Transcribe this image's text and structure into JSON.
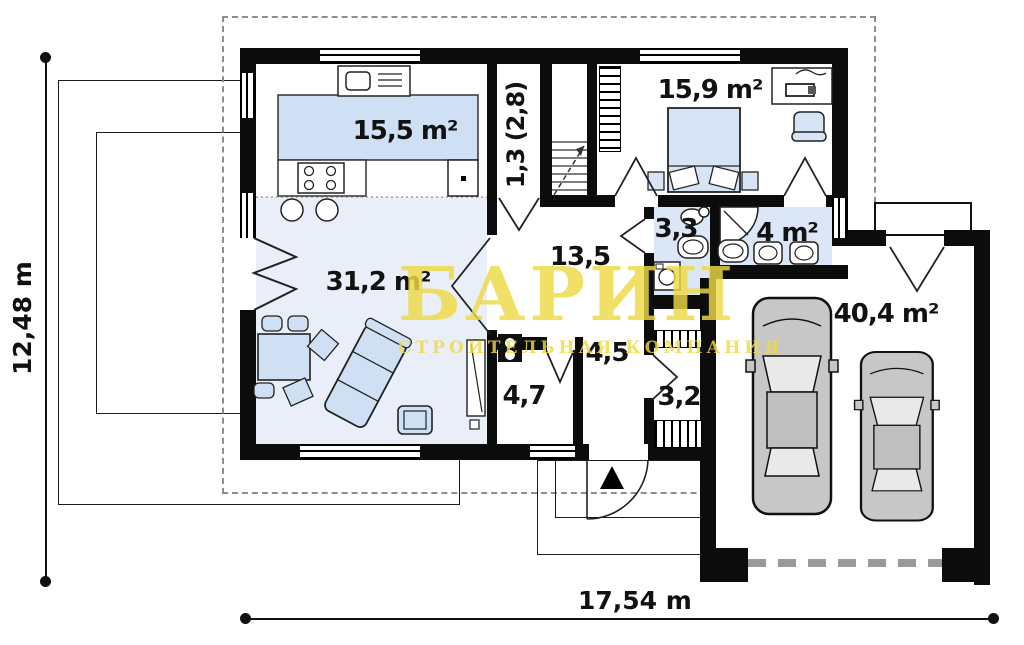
{
  "plan_title": "floor-plan",
  "rooms": {
    "kitchen": {
      "label": "15,5 m²"
    },
    "stairhall": {
      "label": "1,3 (2,8)"
    },
    "bedroom": {
      "label": "15,9 m²"
    },
    "wc": {
      "label": "3,3"
    },
    "bath": {
      "label": "4 m²"
    },
    "hall": {
      "label": "13,5"
    },
    "living": {
      "label": "31,2 m²"
    },
    "corridor": {
      "label": "4,5"
    },
    "utility": {
      "label": "4,7"
    },
    "entry": {
      "label": "3,2"
    },
    "garage": {
      "label": "40,4 m²"
    }
  },
  "dimensions": {
    "height": "12,48 m",
    "width": "17,54 m"
  },
  "watermark": {
    "title": "БАРИН",
    "subtitle": "СТРОИТЕЛЬНАЯ КОМПАНИЯ"
  },
  "colors": {
    "wall": "#0c0c0c",
    "floor_accent": "#e9eef8",
    "wet_floor": "#dbe6f6",
    "furniture": "#cfe0f4",
    "watermark": "#eeda45",
    "roof_dash": "#8e8e8e"
  }
}
